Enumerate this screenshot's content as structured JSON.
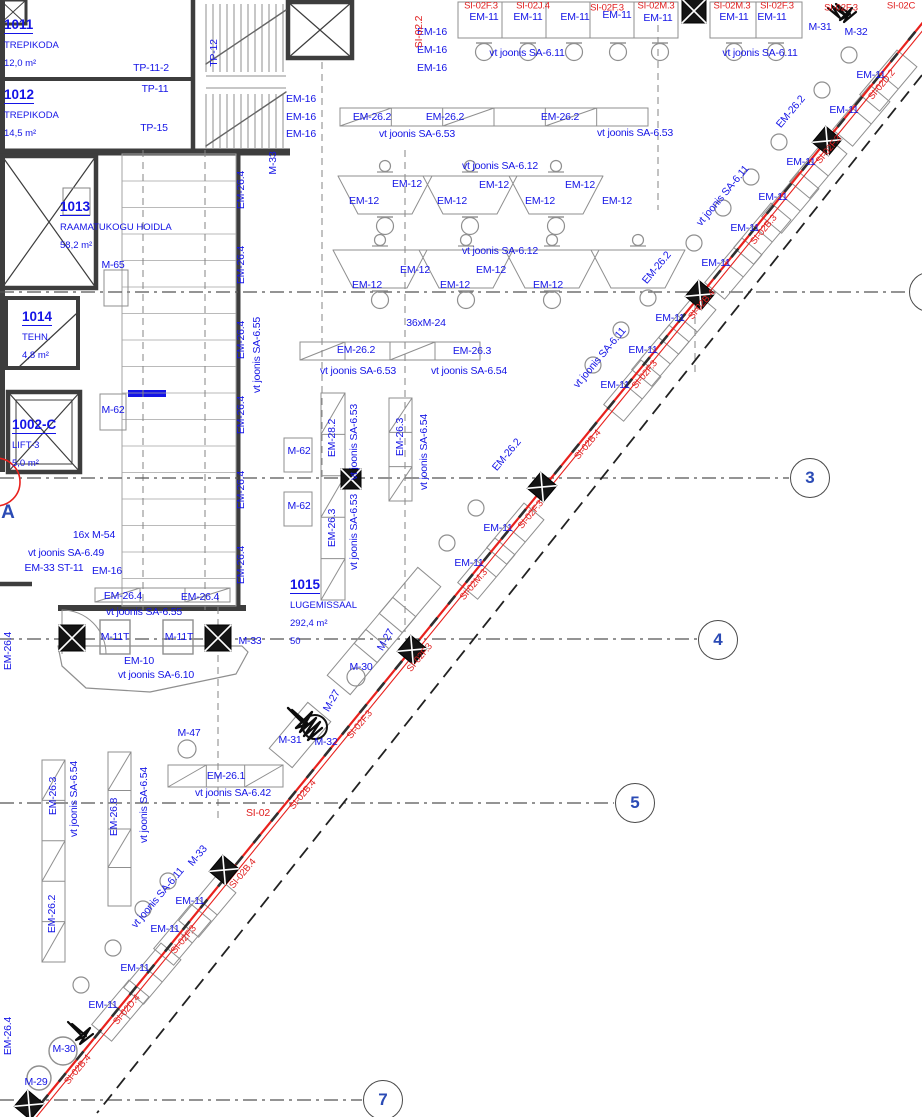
{
  "drawing": {
    "type": "architectural-floor-plan",
    "language": "Estonian",
    "colors": {
      "annotation_blue": "#1414e6",
      "annotation_red": "#e02020",
      "line_red": "#e8211d",
      "grid_number_blue": "#2b4bb5"
    }
  },
  "rooms": [
    {
      "id": "1011",
      "name": "TREPIKODA",
      "area": "12,0 m²"
    },
    {
      "id": "1012",
      "name": "TREPIKODA",
      "area": "14,5 m²"
    },
    {
      "id": "1013",
      "name": "RAAMATUKOGU HOIDLA",
      "area": "58,2 m²"
    },
    {
      "id": "1014",
      "name": "TEHN.",
      "area": "4,8 m²"
    },
    {
      "id": "1002-C",
      "name": "LIFT-3",
      "area": "5,0 m²"
    },
    {
      "id": "1015",
      "name": "LUGEMISSAAL",
      "area": "292,4 m²",
      "occupancy": "50"
    }
  ],
  "grid": {
    "bubbles": [
      {
        "n": "3",
        "x": 810,
        "y": 478
      },
      {
        "n": "4",
        "x": 718,
        "y": 640
      },
      {
        "n": "5",
        "x": 635,
        "y": 803
      },
      {
        "n": "7",
        "x": 383,
        "y": 1100
      },
      {
        "n": "",
        "x": 929,
        "y": 292
      }
    ],
    "letters": [
      {
        "n": "A",
        "x": 8,
        "y": 513
      }
    ]
  },
  "labels": [
    {
      "t": "TP-11-2",
      "x": 151,
      "y": 68
    },
    {
      "t": "TP-12",
      "x": 214,
      "y": 53,
      "r": -90
    },
    {
      "t": "TP-11",
      "x": 155,
      "y": 89
    },
    {
      "t": "TP-15",
      "x": 154,
      "y": 128
    },
    {
      "t": "M-33",
      "x": 273,
      "y": 163,
      "r": -90
    },
    {
      "t": "EM-16",
      "x": 432,
      "y": 32
    },
    {
      "t": "EM-16",
      "x": 432,
      "y": 50
    },
    {
      "t": "EM-16",
      "x": 432,
      "y": 68
    },
    {
      "t": "EM-16",
      "x": 301,
      "y": 99
    },
    {
      "t": "EM-16",
      "x": 301,
      "y": 117
    },
    {
      "t": "EM-16",
      "x": 301,
      "y": 134
    },
    {
      "t": "SI-02.2",
      "x": 419,
      "y": 32,
      "r": -90,
      "c": "r"
    },
    {
      "t": "EM-11",
      "x": 484,
      "y": 17
    },
    {
      "t": "EM-11",
      "x": 528,
      "y": 17
    },
    {
      "t": "EM-11",
      "x": 575,
      "y": 17
    },
    {
      "t": "EM-11",
      "x": 617,
      "y": 15
    },
    {
      "t": "EM-11",
      "x": 658,
      "y": 18
    },
    {
      "t": "EM-11",
      "x": 734,
      "y": 17
    },
    {
      "t": "EM-11",
      "x": 772,
      "y": 17
    },
    {
      "t": "SI-02F.3",
      "x": 481,
      "y": 6,
      "c": "r",
      "s": 9.5
    },
    {
      "t": "SI-02J.4",
      "x": 533,
      "y": 6,
      "c": "r",
      "s": 9.5
    },
    {
      "t": "SI-02F.3",
      "x": 607,
      "y": 8,
      "c": "r",
      "s": 9.5
    },
    {
      "t": "SI-02M.3",
      "x": 656,
      "y": 6,
      "c": "r",
      "s": 9.5
    },
    {
      "t": "SI-02M.3",
      "x": 732,
      "y": 6,
      "c": "r",
      "s": 9.5
    },
    {
      "t": "SI-02F.3",
      "x": 777,
      "y": 6,
      "c": "r",
      "s": 9.5
    },
    {
      "t": "SI-02F.3",
      "x": 841,
      "y": 8,
      "c": "r",
      "s": 9.5
    },
    {
      "t": "SI-02C",
      "x": 901,
      "y": 6,
      "c": "r",
      "s": 9.5
    },
    {
      "t": "M-31",
      "x": 820,
      "y": 27
    },
    {
      "t": "M-32",
      "x": 856,
      "y": 32
    },
    {
      "t": "vt joonis SA-6.11",
      "x": 527,
      "y": 53
    },
    {
      "t": "vt joonis SA-6.11",
      "x": 760,
      "y": 53
    },
    {
      "t": "EM-26.2",
      "x": 372,
      "y": 117
    },
    {
      "t": "EM-26.2",
      "x": 445,
      "y": 117
    },
    {
      "t": "EM-26.2",
      "x": 560,
      "y": 117
    },
    {
      "t": "vt joonis SA-6.53",
      "x": 417,
      "y": 134
    },
    {
      "t": "vt joonis SA-6.53",
      "x": 635,
      "y": 133
    },
    {
      "t": "vt joonis SA-6.12",
      "x": 500,
      "y": 166
    },
    {
      "t": "EM-12",
      "x": 407,
      "y": 184
    },
    {
      "t": "EM-12",
      "x": 494,
      "y": 185
    },
    {
      "t": "EM-12",
      "x": 580,
      "y": 185
    },
    {
      "t": "EM-12",
      "x": 364,
      "y": 201
    },
    {
      "t": "EM-12",
      "x": 452,
      "y": 201
    },
    {
      "t": "EM-12",
      "x": 540,
      "y": 201
    },
    {
      "t": "EM-12",
      "x": 617,
      "y": 201
    },
    {
      "t": "vt joonis SA-6.12",
      "x": 500,
      "y": 251
    },
    {
      "t": "EM-12",
      "x": 415,
      "y": 270
    },
    {
      "t": "EM-12",
      "x": 491,
      "y": 270
    },
    {
      "t": "EM-12",
      "x": 367,
      "y": 285
    },
    {
      "t": "EM-12",
      "x": 455,
      "y": 285
    },
    {
      "t": "EM-12",
      "x": 548,
      "y": 285
    },
    {
      "t": "36xM-24",
      "x": 426,
      "y": 323
    },
    {
      "t": "EM-26.2",
      "x": 356,
      "y": 350
    },
    {
      "t": "EM-26.3",
      "x": 472,
      "y": 351
    },
    {
      "t": "vt joonis SA-6.53",
      "x": 358,
      "y": 371
    },
    {
      "t": "vt joonis SA-6.54",
      "x": 469,
      "y": 371
    },
    {
      "t": "M-65",
      "x": 113,
      "y": 265
    },
    {
      "t": "M-62",
      "x": 113,
      "y": 410
    },
    {
      "t": "M-62",
      "x": 299,
      "y": 451
    },
    {
      "t": "M-62",
      "x": 299,
      "y": 506
    },
    {
      "t": "EM-26.4",
      "x": 241,
      "y": 190,
      "r": -90
    },
    {
      "t": "EM-26.4",
      "x": 241,
      "y": 265,
      "r": -90
    },
    {
      "t": "EM-26.4",
      "x": 241,
      "y": 340,
      "r": -90
    },
    {
      "t": "EM-26.4",
      "x": 241,
      "y": 415,
      "r": -90
    },
    {
      "t": "EM-26.4",
      "x": 241,
      "y": 490,
      "r": -90
    },
    {
      "t": "EM-26.4",
      "x": 241,
      "y": 565,
      "r": -90
    },
    {
      "t": "vt joonis SA-6.55",
      "x": 257,
      "y": 355,
      "r": -90
    },
    {
      "t": "EM-28.2",
      "x": 332,
      "y": 438,
      "r": -90
    },
    {
      "t": "vt joonis SA-6.53",
      "x": 354,
      "y": 442,
      "r": -90
    },
    {
      "t": "EM-26.3",
      "x": 332,
      "y": 528,
      "r": -90
    },
    {
      "t": "vt joonis SA-6.53",
      "x": 354,
      "y": 532,
      "r": -90
    },
    {
      "t": "EM-26.3",
      "x": 400,
      "y": 437,
      "r": -90
    },
    {
      "t": "vt joonis SA-6.54",
      "x": 424,
      "y": 452,
      "r": -90
    },
    {
      "t": "16x M-54",
      "x": 94,
      "y": 535
    },
    {
      "t": "vt joonis SA-6.49",
      "x": 66,
      "y": 553
    },
    {
      "t": "EM-33 ST-11",
      "x": 54,
      "y": 568
    },
    {
      "t": "EM-16",
      "x": 107,
      "y": 571
    },
    {
      "t": "EM-26.4",
      "x": 123,
      "y": 596
    },
    {
      "t": "EM-26.4",
      "x": 200,
      "y": 597
    },
    {
      "t": "vt joonis SA-6.55",
      "x": 144,
      "y": 612
    },
    {
      "t": "M-11T",
      "x": 115,
      "y": 637
    },
    {
      "t": "M-11T",
      "x": 179,
      "y": 637
    },
    {
      "t": "M-33",
      "x": 250,
      "y": 641
    },
    {
      "t": "EM-10",
      "x": 139,
      "y": 661
    },
    {
      "t": "vt joonis SA-6.10",
      "x": 156,
      "y": 675
    },
    {
      "t": "EM-26.4",
      "x": 8,
      "y": 651,
      "r": -90
    },
    {
      "t": "EM-26.4",
      "x": 8,
      "y": 1036,
      "r": -90
    },
    {
      "t": "EM-26.3",
      "x": 53,
      "y": 796,
      "r": -90
    },
    {
      "t": "vt joonis SA-6.54",
      "x": 74,
      "y": 799,
      "r": -90
    },
    {
      "t": "EM-26.2",
      "x": 52,
      "y": 914,
      "r": -90
    },
    {
      "t": "EM-26.8",
      "x": 114,
      "y": 817,
      "r": -90
    },
    {
      "t": "vt joonis SA-6.54",
      "x": 144,
      "y": 805,
      "r": -90
    },
    {
      "t": "M-47",
      "x": 189,
      "y": 733
    },
    {
      "t": "EM-26.1",
      "x": 226,
      "y": 776
    },
    {
      "t": "vt joonis SA-6.42",
      "x": 233,
      "y": 793
    },
    {
      "t": "SI-02",
      "x": 258,
      "y": 813,
      "c": "r"
    },
    {
      "t": "M-31",
      "x": 290,
      "y": 740
    },
    {
      "t": "M-32",
      "x": 326,
      "y": 742
    },
    {
      "t": "M-27",
      "x": 332,
      "y": 701,
      "r": -60
    },
    {
      "t": "M-27",
      "x": 386,
      "y": 640,
      "r": -60
    },
    {
      "t": "M-30",
      "x": 361,
      "y": 667
    },
    {
      "t": "M-30",
      "x": 64,
      "y": 1049
    },
    {
      "t": "M-29",
      "x": 36,
      "y": 1082
    },
    {
      "t": "EM-11",
      "x": 871,
      "y": 75,
      "d": 1
    },
    {
      "t": "EM-11",
      "x": 844,
      "y": 110,
      "d": 1
    },
    {
      "t": "EM-11",
      "x": 801,
      "y": 162,
      "d": 1
    },
    {
      "t": "EM-11",
      "x": 773,
      "y": 197,
      "d": 1
    },
    {
      "t": "EM-11",
      "x": 745,
      "y": 228,
      "d": 1
    },
    {
      "t": "EM-11",
      "x": 716,
      "y": 263,
      "d": 1
    },
    {
      "t": "EM-11",
      "x": 670,
      "y": 318,
      "d": 1
    },
    {
      "t": "EM-11",
      "x": 643,
      "y": 350,
      "d": 1
    },
    {
      "t": "EM-11",
      "x": 615,
      "y": 385,
      "d": 1
    },
    {
      "t": "EM-11",
      "x": 498,
      "y": 528,
      "d": 1
    },
    {
      "t": "EM-11",
      "x": 469,
      "y": 563,
      "d": 1
    },
    {
      "t": "EM-11",
      "x": 190,
      "y": 901,
      "d": 1
    },
    {
      "t": "EM-11",
      "x": 165,
      "y": 929,
      "d": 1
    },
    {
      "t": "EM-11",
      "x": 135,
      "y": 968,
      "d": 1
    },
    {
      "t": "EM-11",
      "x": 103,
      "y": 1005,
      "d": 1
    },
    {
      "t": "EM-26.2",
      "x": 791,
      "y": 112,
      "r": -50
    },
    {
      "t": "EM-26.2",
      "x": 657,
      "y": 268,
      "r": -50
    },
    {
      "t": "EM-26.2",
      "x": 507,
      "y": 455,
      "r": -50
    },
    {
      "t": "vt joonis SA-6.11",
      "x": 723,
      "y": 196,
      "r": -50
    },
    {
      "t": "vt joonis SA-6.11",
      "x": 600,
      "y": 358,
      "r": -50
    },
    {
      "t": "vt joonis SA-6.11",
      "x": 158,
      "y": 898,
      "r": -50
    },
    {
      "t": "M-33",
      "x": 198,
      "y": 856,
      "r": -50
    },
    {
      "t": "SI-02D.2",
      "x": 882,
      "y": 85,
      "r": -50,
      "c": "r",
      "s": 9.5
    },
    {
      "t": "SI-02F.3",
      "x": 829,
      "y": 150,
      "r": -50,
      "c": "r",
      "s": 9.5
    },
    {
      "t": "SI-02B.3",
      "x": 764,
      "y": 230,
      "r": -50,
      "c": "r",
      "s": 9.5
    },
    {
      "t": "SI-02B.4",
      "x": 702,
      "y": 305,
      "r": -50,
      "c": "r",
      "s": 9.5
    },
    {
      "t": "SI-02F.3",
      "x": 645,
      "y": 375,
      "r": -50,
      "c": "r",
      "s": 9.5
    },
    {
      "t": "SI-02B.4",
      "x": 588,
      "y": 445,
      "r": -50,
      "c": "r",
      "s": 9.5
    },
    {
      "t": "SI-02F.3",
      "x": 531,
      "y": 515,
      "r": -50,
      "c": "r",
      "s": 9.5
    },
    {
      "t": "SI-02M.3",
      "x": 474,
      "y": 585,
      "r": -50,
      "c": "r",
      "s": 9.5
    },
    {
      "t": "SI-02F.3",
      "x": 420,
      "y": 658,
      "r": -50,
      "c": "r",
      "s": 9.5
    },
    {
      "t": "SI-02F.3",
      "x": 360,
      "y": 725,
      "r": -50,
      "c": "r",
      "s": 9.5
    },
    {
      "t": "SI-02B.4",
      "x": 303,
      "y": 795,
      "r": -50,
      "c": "r",
      "s": 9.5
    },
    {
      "t": "SI-02B.4",
      "x": 243,
      "y": 874,
      "r": -50,
      "c": "r",
      "s": 9.5
    },
    {
      "t": "SI-02F.3",
      "x": 184,
      "y": 940,
      "r": -50,
      "c": "r",
      "s": 9.5
    },
    {
      "t": "SI-02D.4",
      "x": 127,
      "y": 1010,
      "r": -50,
      "c": "r",
      "s": 9.5
    },
    {
      "t": "SI-02B.4",
      "x": 78,
      "y": 1070,
      "r": -50,
      "c": "r",
      "s": 9.5
    }
  ]
}
